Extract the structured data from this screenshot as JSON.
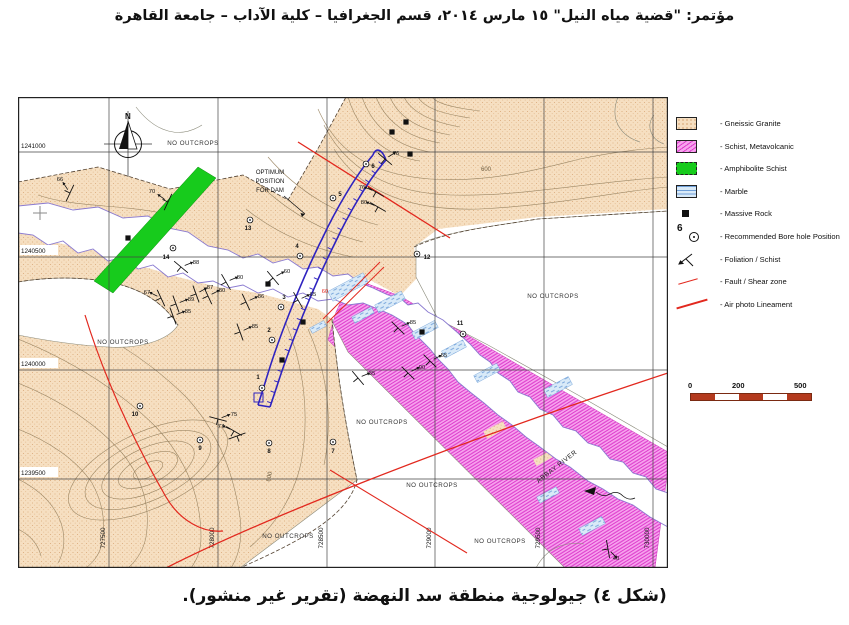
{
  "page": {
    "header": "مؤتمر: \"قضية مياه النيل\" ١٥ مارس ٢٠١٤، قسم الجغرافيا – كلية الآداب – جامعة القاهرة",
    "caption": "(شكل ٤) جيولوجية منطقة سد النهضة (تقرير غير منشور)."
  },
  "legend": {
    "borehole_num": "6",
    "items": [
      {
        "type": "granite",
        "label": "- Gneissic Granite"
      },
      {
        "type": "schist",
        "label": "- Schist, Metavolcanic"
      },
      {
        "type": "amphibolite",
        "label": "- Amphibolite Schist"
      },
      {
        "type": "marble",
        "label": "- Marble"
      },
      {
        "type": "massive",
        "label": "- Massive Rock"
      },
      {
        "type": "borehole",
        "label": "- Recommended Bore hole Position"
      },
      {
        "type": "foliation",
        "label": "- Foliation / Schist"
      },
      {
        "type": "fault",
        "label": "- Fault / Shear zone"
      },
      {
        "type": "lineament",
        "label": "- Air photo Lineament"
      }
    ]
  },
  "scalebar": {
    "t0": "0",
    "t200": "200",
    "t500": "500 m"
  },
  "map": {
    "north_label": "N",
    "river_label": "ABBAY RIVER",
    "no_outcrops": "NO OUTCROPS",
    "no_outcrops_pos": [
      [
        175,
        48
      ],
      [
        535,
        201
      ],
      [
        105,
        247
      ],
      [
        364,
        327
      ],
      [
        414,
        390
      ],
      [
        482,
        446
      ],
      [
        270,
        441
      ]
    ],
    "dam_note": [
      "OPTIMUM",
      "POSITION",
      "FOR DAM"
    ],
    "contour_labels": [
      [
        "600",
        468,
        74,
        0
      ],
      [
        "600",
        253,
        380,
        -78
      ]
    ],
    "grid_x": [
      [
        "727500",
        91
      ],
      [
        "728000",
        200
      ],
      [
        "728500",
        309
      ],
      [
        "729000",
        417
      ],
      [
        "729500",
        526
      ],
      [
        "730000",
        635
      ]
    ],
    "grid_y": [
      [
        "1241000",
        55
      ],
      [
        "1240500",
        160
      ],
      [
        "1240000",
        273
      ],
      [
        "1239500",
        382
      ]
    ],
    "boreholes": [
      [
        "1",
        244,
        291,
        240,
        282
      ],
      [
        "2",
        254,
        243,
        251,
        235
      ],
      [
        "3",
        263,
        210,
        266,
        202
      ],
      [
        "4",
        282,
        159,
        279,
        151
      ],
      [
        "5",
        315,
        101,
        322,
        99
      ],
      [
        "6",
        348,
        67,
        355,
        71
      ],
      [
        "7",
        315,
        345,
        315,
        356
      ],
      [
        "8",
        251,
        346,
        251,
        356
      ],
      [
        "9",
        182,
        343,
        182,
        353
      ],
      [
        "10",
        122,
        309,
        117,
        319
      ],
      [
        "11",
        445,
        237,
        442,
        228
      ],
      [
        "12",
        399,
        157,
        409,
        162
      ],
      [
        "13",
        232,
        123,
        230,
        133
      ],
      [
        "14",
        155,
        151,
        148,
        162
      ]
    ],
    "rocks": [
      [
        374,
        35
      ],
      [
        388,
        25
      ],
      [
        392,
        57
      ],
      [
        110,
        141
      ],
      [
        250,
        187
      ],
      [
        285,
        225
      ],
      [
        264,
        263
      ],
      [
        404,
        235
      ]
    ],
    "strikes": [
      [
        "66",
        52,
        96,
        115,
        42,
        84
      ],
      [
        "70",
        150,
        105,
        115,
        134,
        96
      ],
      [
        "88",
        163,
        170,
        40,
        178,
        167
      ],
      [
        "67",
        143,
        201,
        65,
        129,
        197
      ],
      [
        "87",
        178,
        197,
        70,
        192,
        192
      ],
      [
        "89",
        158,
        207,
        70,
        173,
        204
      ],
      [
        "85",
        155,
        219,
        70,
        170,
        216
      ],
      [
        "80",
        208,
        185,
        60,
        222,
        182
      ],
      [
        "80",
        190,
        199,
        65,
        204,
        195
      ],
      [
        "86",
        228,
        205,
        65,
        243,
        201
      ],
      [
        "60",
        255,
        181,
        50,
        269,
        176
      ],
      [
        "65",
        280,
        203,
        60,
        295,
        199
      ],
      [
        "85",
        222,
        235,
        70,
        237,
        231
      ],
      [
        "85",
        380,
        231,
        45,
        395,
        227
      ],
      [
        "55",
        412,
        264,
        45,
        426,
        260
      ],
      [
        "90",
        390,
        276,
        45,
        404,
        272
      ],
      [
        "35",
        340,
        281,
        50,
        354,
        278
      ],
      [
        "76",
        358,
        95,
        30,
        344,
        92
      ],
      [
        "80",
        360,
        110,
        30,
        346,
        107
      ],
      [
        "76",
        367,
        62,
        40,
        378,
        58
      ],
      [
        "75",
        200,
        322,
        15,
        216,
        319
      ],
      [
        "77",
        216,
        334,
        30,
        203,
        331
      ],
      [
        "40",
        590,
        452,
        80,
        598,
        463
      ],
      [
        "",
        219,
        339,
        -20,
        219,
        330
      ]
    ],
    "red_labels": [
      [
        "60",
        307,
        196
      ]
    ],
    "marble_lenses": [
      [
        330,
        190,
        40,
        11
      ],
      [
        372,
        205,
        30,
        9
      ],
      [
        345,
        218,
        22,
        7
      ],
      [
        407,
        233,
        26,
        8
      ],
      [
        436,
        252,
        24,
        8
      ],
      [
        469,
        276,
        26,
        8
      ],
      [
        540,
        290,
        28,
        9
      ],
      [
        574,
        429,
        26,
        8
      ],
      [
        300,
        230,
        16,
        6
      ],
      [
        530,
        398,
        22,
        7
      ]
    ]
  },
  "colors": {
    "granite": "#f6dfc1",
    "granite_dot": "#d8a877",
    "schist_bg": "#f7a3ee",
    "schist_line": "#dd3ccc",
    "amphibolite": "#17cb1c",
    "marble_bg": "#d9eaf8",
    "marble_line": "#6f9fd8",
    "fault_red": "#e2281e",
    "dam_blue": "#2f23c0",
    "river_bank": "#8a7ad0",
    "contour": "#9c8765",
    "scalebar": "#b43a1e"
  }
}
